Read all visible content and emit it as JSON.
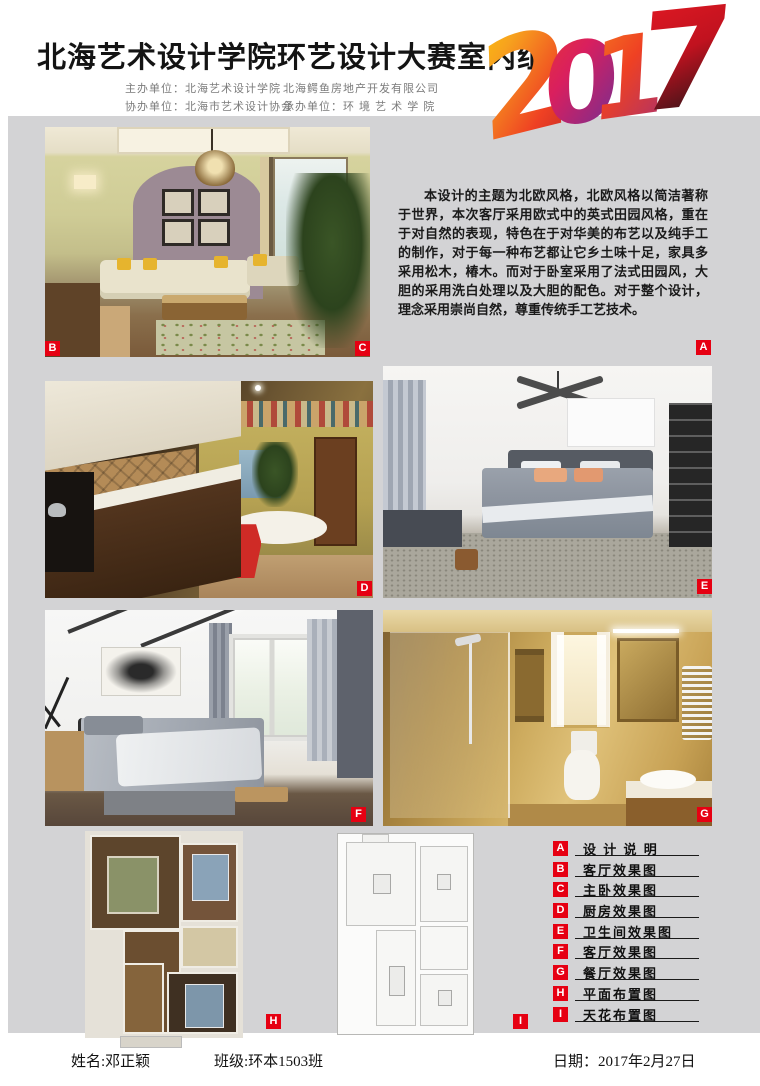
{
  "page": {
    "accent_red": "#e60012",
    "board_gray": "#d3d3d5",
    "background": "#ffffff"
  },
  "header": {
    "title": "北海艺术设计学院环艺设计大赛室内组",
    "year_digits": [
      "2",
      "0",
      "1",
      "7"
    ],
    "organizer_lines": [
      {
        "left": "主办单位：北海艺术设计学院",
        "right": "北海鳄鱼房地产开发有限公司"
      },
      {
        "left": "协办单位：北海市艺术设计协会",
        "right": "承办单位：环 境 艺 术 学 院"
      }
    ]
  },
  "description": {
    "text": "本设计的主题为北欧风格，北欧风格以简洁著称于世界，本次客厅采用欧式中的英式田园风格，重在于对自然的表现，特色在于对华美的布艺以及纯手工的制作，对于每一种布艺都让它乡土味十足，家具多采用松木，椿木。而对于卧室采用了法式田园风，大胆的采用洗白处理以及大胆的配色。对于整个设计，理念采用崇尚自然，尊重传统手工艺技术。"
  },
  "legend": {
    "items": [
      {
        "key": "A",
        "label": "设 计 说 明"
      },
      {
        "key": "B",
        "label": "客厅效果图"
      },
      {
        "key": "C",
        "label": "主卧效果图"
      },
      {
        "key": "D",
        "label": "厨房效果图"
      },
      {
        "key": "E",
        "label": "卫生间效果图"
      },
      {
        "key": "F",
        "label": "客厅效果图"
      },
      {
        "key": "G",
        "label": "餐厅效果图"
      },
      {
        "key": "H",
        "label": "平面布置图"
      },
      {
        "key": "I",
        "label": "天花布置图"
      }
    ]
  },
  "footer": {
    "name": "姓名:邓正颖",
    "class": "班级:环本1503班",
    "date": "日期：2017年2月27日"
  }
}
